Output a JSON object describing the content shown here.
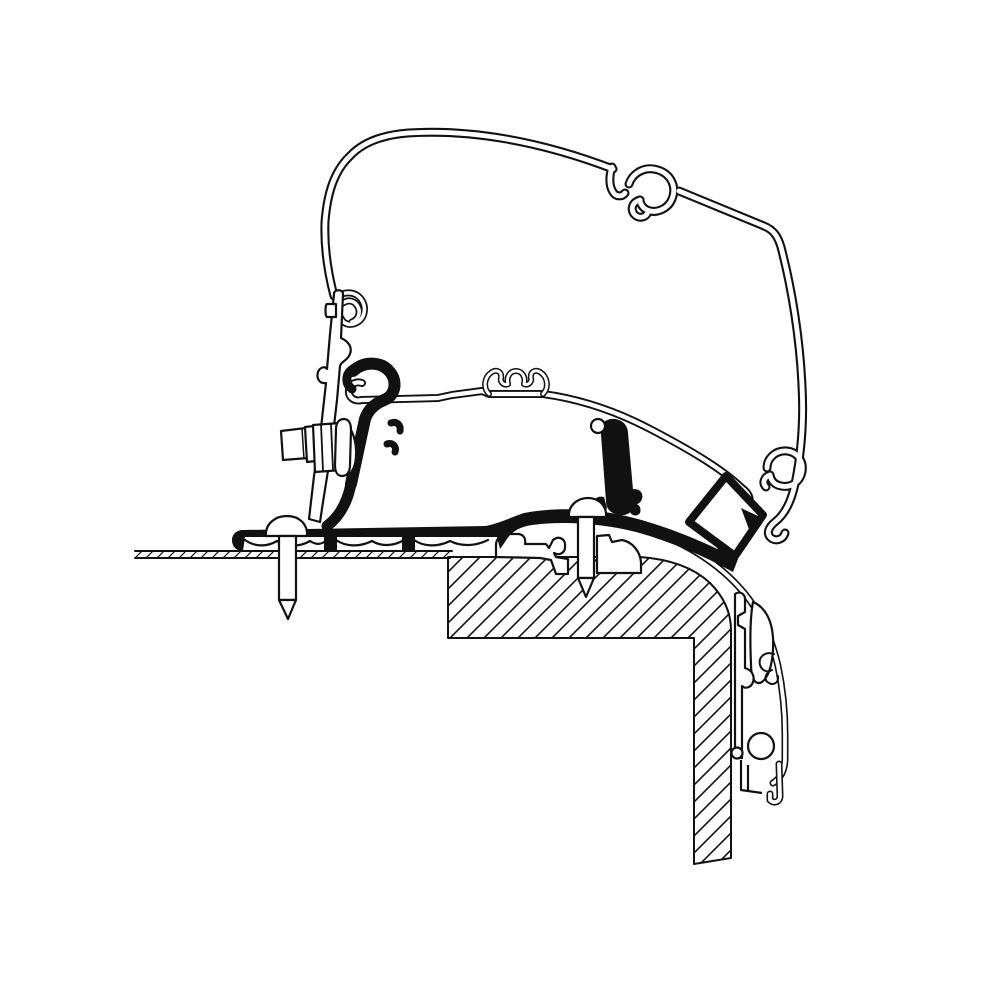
{
  "meta": {
    "description": "Cross-section technical line drawing of an awning rail adapter bracket clamped to an awning case profile and screwed to a vehicle roof-to-wall corner",
    "drawing_style": "black line art on white, diagonal hatching for cut material",
    "canvas_width": 1000,
    "canvas_height": 1000
  },
  "colors": {
    "line": "#111111",
    "background": "#ffffff",
    "solid_seal_parts": "#111111"
  },
  "parts": [
    {
      "id": "awning-case-profile",
      "label": "Awning case mounting profile (double-line outline)"
    },
    {
      "id": "top-hook-clip",
      "label": "Hook clip recess at top of case profile"
    },
    {
      "id": "lower-adapter-rail",
      "label": "Inclined adapter rail profile with middle clip"
    },
    {
      "id": "clamp-bracket-plate",
      "label": "Tilted clamp bracket plate"
    },
    {
      "id": "hex-bolt",
      "label": "Hex head clamping bolt with collar and washer"
    },
    {
      "id": "seal-profile",
      "label": "Solid black rubber seal / adapter base profile"
    },
    {
      "id": "roof-screw-left",
      "label": "Left roof fixing screw"
    },
    {
      "id": "roof-screw-right",
      "label": "Right roof fixing screw"
    },
    {
      "id": "roof-panel",
      "label": "Thin vehicle roof panel (hatched)"
    },
    {
      "id": "roof-corner-block",
      "label": "Roof corner block (hatched, rounded edge)"
    },
    {
      "id": "side-wall",
      "label": "Vertical vehicle side wall (hatched)"
    },
    {
      "id": "wall-edge-trim",
      "label": "Curved wall edge trim rail with circular channel and fork foot"
    },
    {
      "id": "foam-spacer-block",
      "label": "Tilted square foam spacer block"
    }
  ]
}
